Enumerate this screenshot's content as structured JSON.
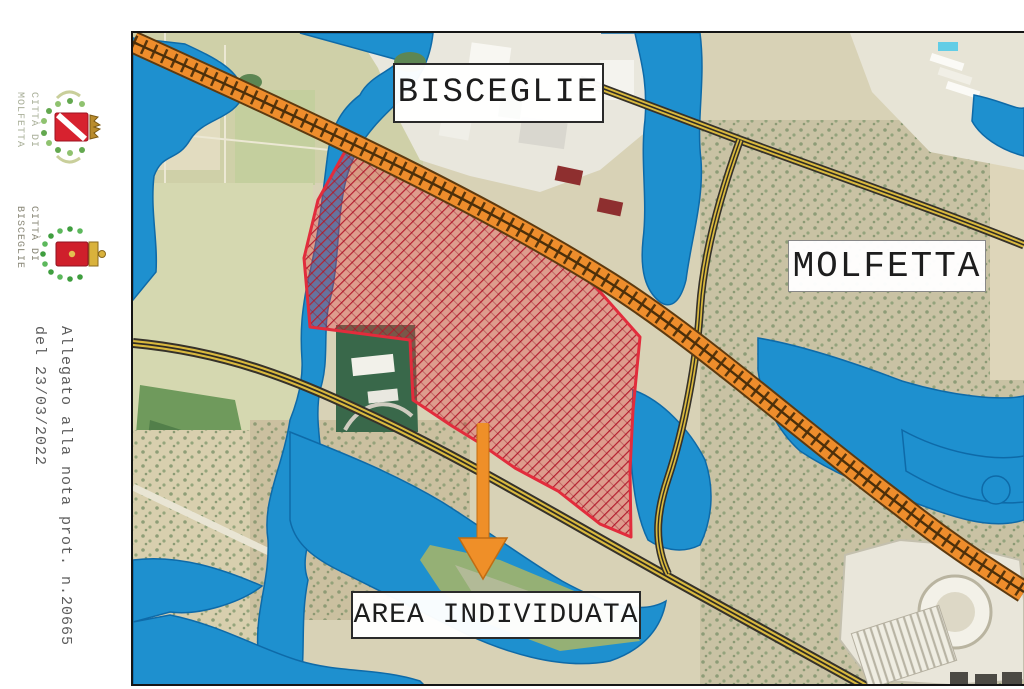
{
  "sidebar": {
    "molfetta_coat": {
      "line1": "CITTÀ DI",
      "line2": "MOLFETTA"
    },
    "bisceglie_coat": {
      "line1": "CITTÀ DI",
      "line2": "BISCEGLIE"
    },
    "note_line1": "Allegato alla nota prot. n.20665",
    "note_line2": "del 23/03/2022"
  },
  "map_labels": {
    "bisceglie": "BISCEGLIE",
    "molfetta": "MOLFETTA",
    "area": "AREA INDIVIDUATA"
  },
  "colors": {
    "water": "#1e90cf",
    "railway": "#ee8d2c",
    "road_yellow": "#d9b93e",
    "area_outline": "#e22c3c",
    "area_hatch": "#b51f30",
    "arrow": "#ef8f28",
    "land": "#d8d2b6"
  }
}
